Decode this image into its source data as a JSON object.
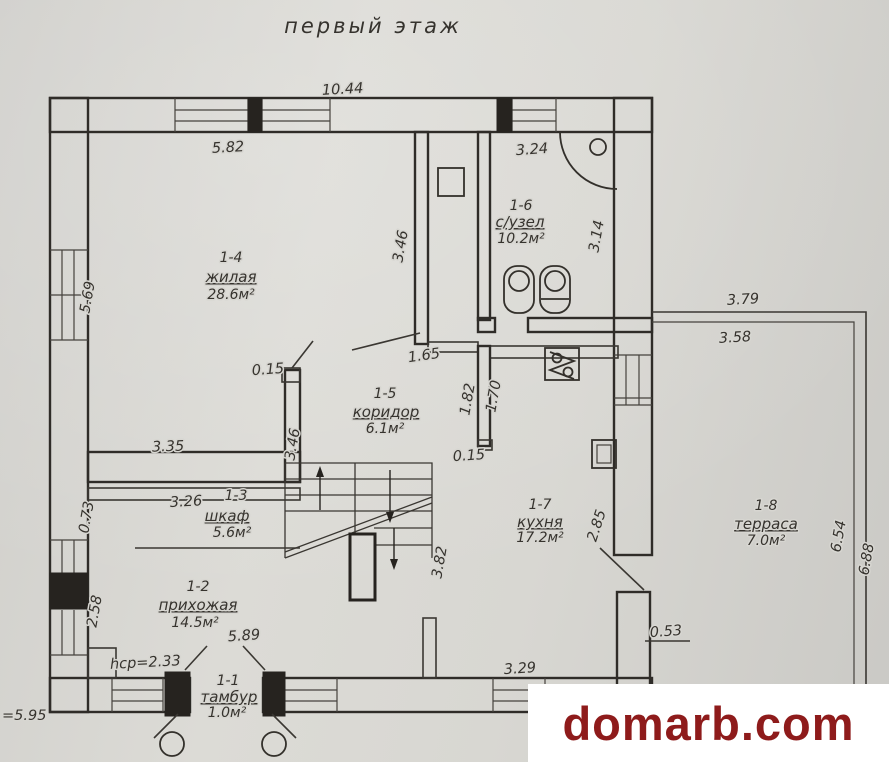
{
  "title": "первый этаж",
  "watermark": {
    "text": "domarb.com"
  },
  "colors": {
    "paper": "#d7d6d1",
    "ink": "#2f2c28",
    "watermark_text": "#8e1b1b",
    "watermark_bg": "#ffffff"
  },
  "rooms": [
    {
      "id": "1-4",
      "name": "жилая",
      "area": "28.6м²"
    },
    {
      "id": "1-6",
      "name": "с/узел",
      "area": "10.2м²"
    },
    {
      "id": "1-5",
      "name": "коридор",
      "area": "6.1м²"
    },
    {
      "id": "1-3",
      "name": "шкаф",
      "area": "5.6м²"
    },
    {
      "id": "1-7",
      "name": "кухня",
      "area": "17.2м²"
    },
    {
      "id": "1-2",
      "name": "прихожая",
      "area": "14.5м²"
    },
    {
      "id": "1-1",
      "name": "тамбур",
      "area": "1.0м²"
    },
    {
      "id": "1-8",
      "name": "терраса",
      "area": "7.0м²"
    }
  ],
  "dimensions": {
    "overall_top": "10.44",
    "living_width": "5.82",
    "bath_width": "3.24",
    "bath_right_height": "3.14",
    "living_right_height": "3.46",
    "living_left_height": "5.69",
    "living_bottom": "3.35",
    "corridor_stub_left": "0.15",
    "corridor_top": "1.65",
    "corridor_left_height": "3.46",
    "kitchen_wall_upper": "1.82",
    "kitchen_wall_inner": "1.70",
    "kitchen_stub": "0.15",
    "closet_width": "3.26",
    "closet_depth": "0.73",
    "hall_left_height": "2.58",
    "hall_width": "5.89",
    "ceiling_note": "hcp=2.33",
    "left_note": "=5.95",
    "stairs_length": "3.82",
    "kitchen_right_height": "2.85",
    "kitchen_notch": "0.53",
    "kitchen_bottom": "3.29",
    "terrace_top_outer": "3.79",
    "terrace_top_inner": "3.58",
    "terrace_right_inner": "6.54",
    "terrace_right_outer": "6.88"
  }
}
